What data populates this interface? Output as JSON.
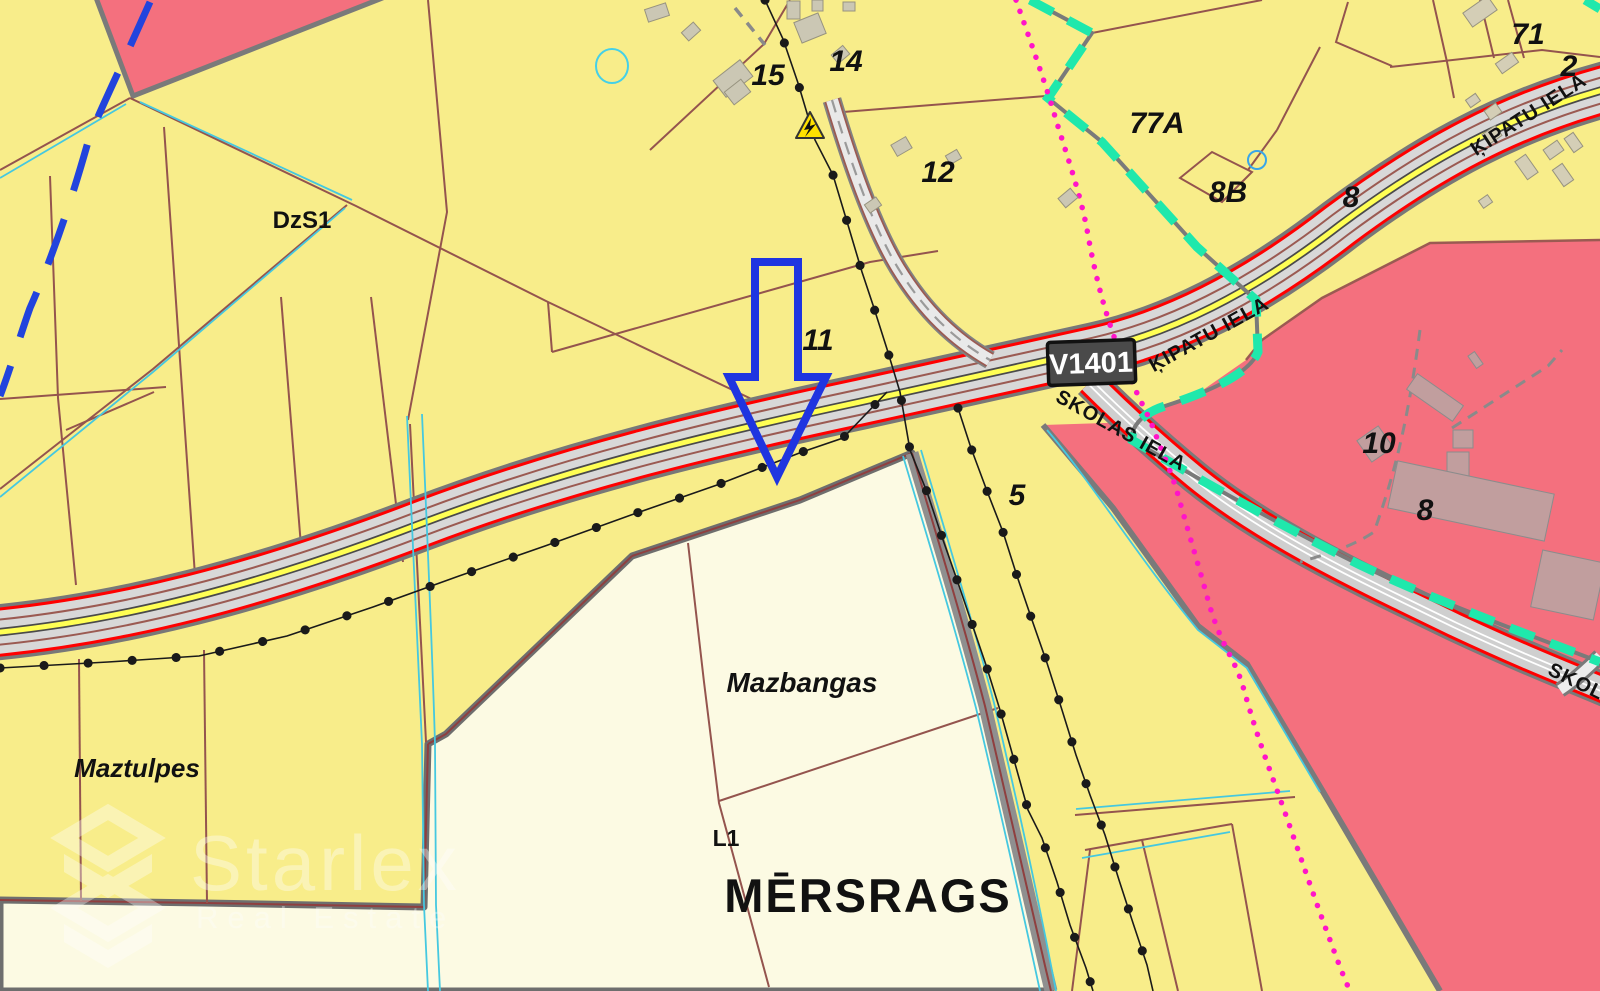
{
  "map": {
    "road_badge": {
      "ref": "V1401"
    },
    "streets": {
      "skolas_at_junction": "SKOLAS IELA",
      "kipatu_at_junction": "ĶIPATU IELA",
      "kipatu_northeast": "ĶIPATU IELA",
      "skolas_southeast": "SKOLAS IELA"
    },
    "places": {
      "zoning_code": "DzS1",
      "farm_maztulpes": "Maztulpes",
      "farm_mazbangas": "Mazbangas",
      "parcel_code_l1": "L1",
      "village": "MĒRSRAGS"
    },
    "parcels": {
      "n15": "15",
      "n14": "14",
      "n12": "12",
      "n11": "11",
      "n5": "5",
      "n77a": "77A",
      "n8b": "8B",
      "n8": "8",
      "n71": "71",
      "n2": "2",
      "n10": "10",
      "n8_school": "8"
    },
    "icons": {
      "electrical_hazard": "high-voltage-warning-triangle",
      "selected_location": "blue-down-arrow-outline"
    },
    "colors": {
      "zone_yellow": "#F8ED8A",
      "zone_cream": "#FCFAE3",
      "zone_pink": "#F4707E",
      "road_fill": "#D8D8D8",
      "road_edge_red": "#FF0000",
      "road_center_yellow": "#FFFF54",
      "parcel_line": "#94544E",
      "boundary_teal": "#1FE8AC",
      "boundary_magenta": "#FF14C8",
      "water_cyan": "#45C8E0",
      "stream_blue": "#2244DD",
      "arrow_blue": "#1F35E0",
      "building_gray": "#CBC7B4",
      "building_mauve": "#C19E9E"
    }
  },
  "watermark": {
    "brand": "Starlex",
    "tagline": "Real Estate"
  }
}
